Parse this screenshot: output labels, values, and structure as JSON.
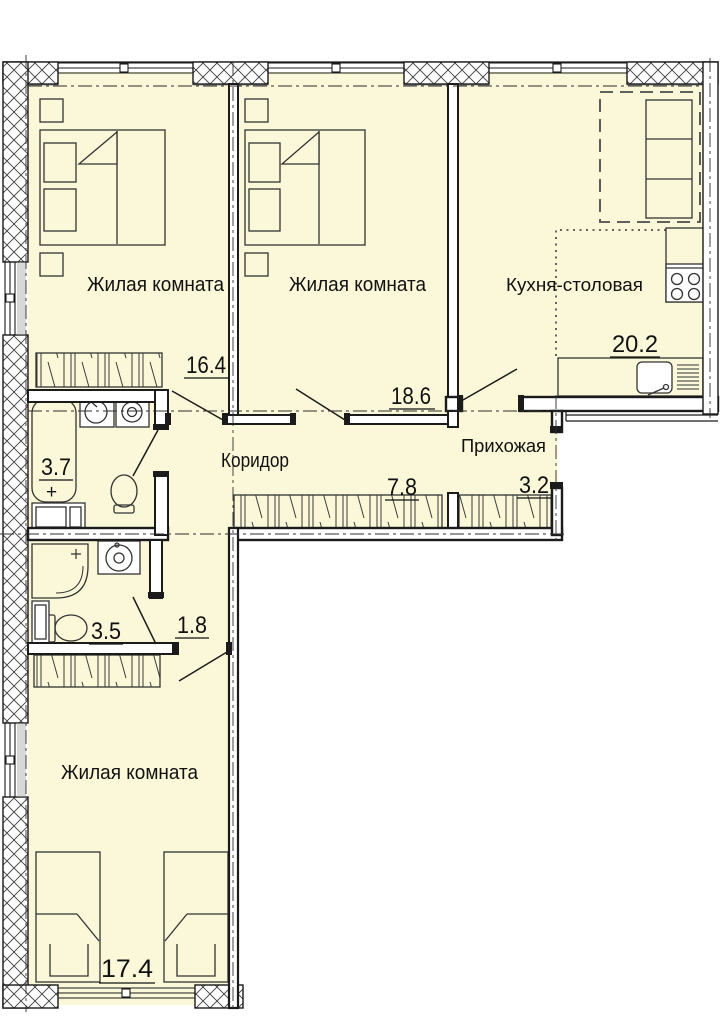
{
  "plan_title": "3-room apartment floor plan",
  "rooms": [
    {
      "id": "living-1",
      "name": "Жилая комната",
      "area": "16.4"
    },
    {
      "id": "living-2",
      "name": "Жилая комната",
      "area": "18.6"
    },
    {
      "id": "kitchen-dining",
      "name": "Кухня-столовая",
      "area": "20.2"
    },
    {
      "id": "corridor",
      "name": "Коридор",
      "area": "7.8"
    },
    {
      "id": "hallway",
      "name": "Прихожая",
      "area": "3.2"
    },
    {
      "id": "bathroom",
      "name": "",
      "area": "3.7"
    },
    {
      "id": "shower-room",
      "name": "",
      "area": "3.5"
    },
    {
      "id": "closet",
      "name": "",
      "area": "1.8"
    },
    {
      "id": "living-3",
      "name": "Жилая комната",
      "area": "17.4"
    }
  ],
  "symbols": {
    "plus": "+"
  },
  "colors": {
    "floor": "#faf8d8",
    "wall_line": "#1b1b1b",
    "lintel_grey": "#d8d8d8",
    "paper": "#ffffff"
  }
}
